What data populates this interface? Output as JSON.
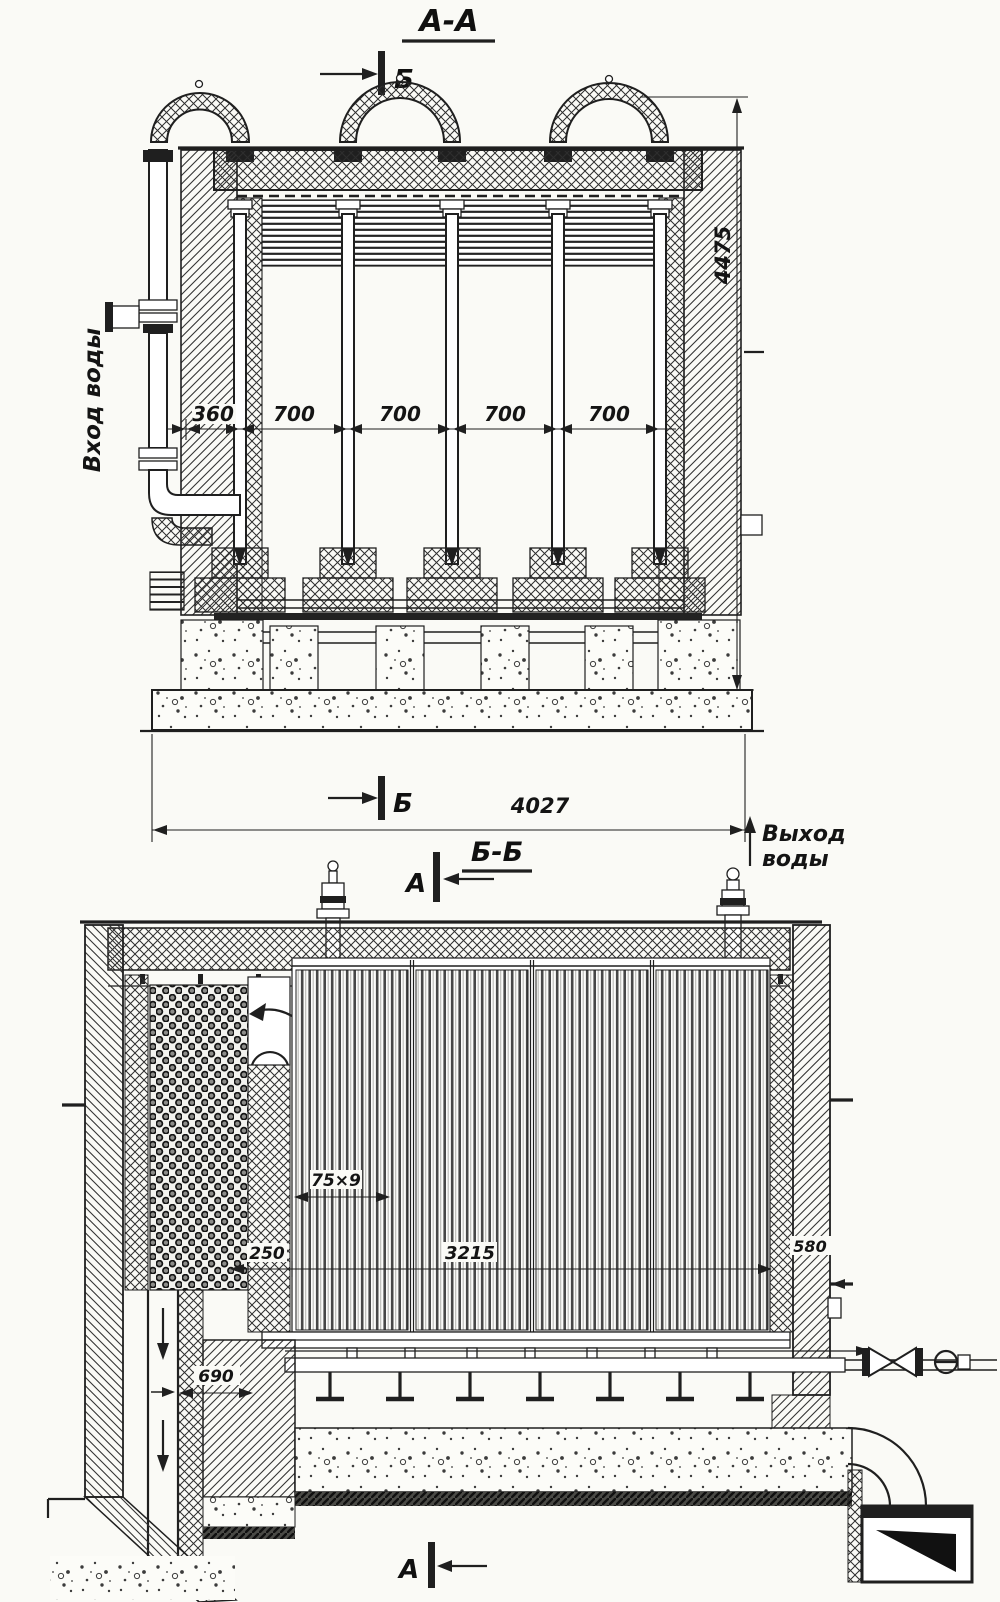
{
  "page": {
    "background": "#fafaf6",
    "ink": "#1f1f1f"
  },
  "top_view": {
    "title": "А-А",
    "marker": "Б",
    "inlet_label": "Вход воды",
    "dims": {
      "offset": "360",
      "bay": "700",
      "total_height": "4475",
      "total_width": "4027"
    }
  },
  "bottom_view": {
    "title": "Б-Б",
    "marker": "А",
    "outlet_label_1": "Выход",
    "outlet_label_2": "воды",
    "dims": {
      "tube_pitch": "75×9",
      "economizer_depth": "250",
      "screen_span": "3215",
      "wall": "580",
      "flue_width": "690"
    }
  }
}
